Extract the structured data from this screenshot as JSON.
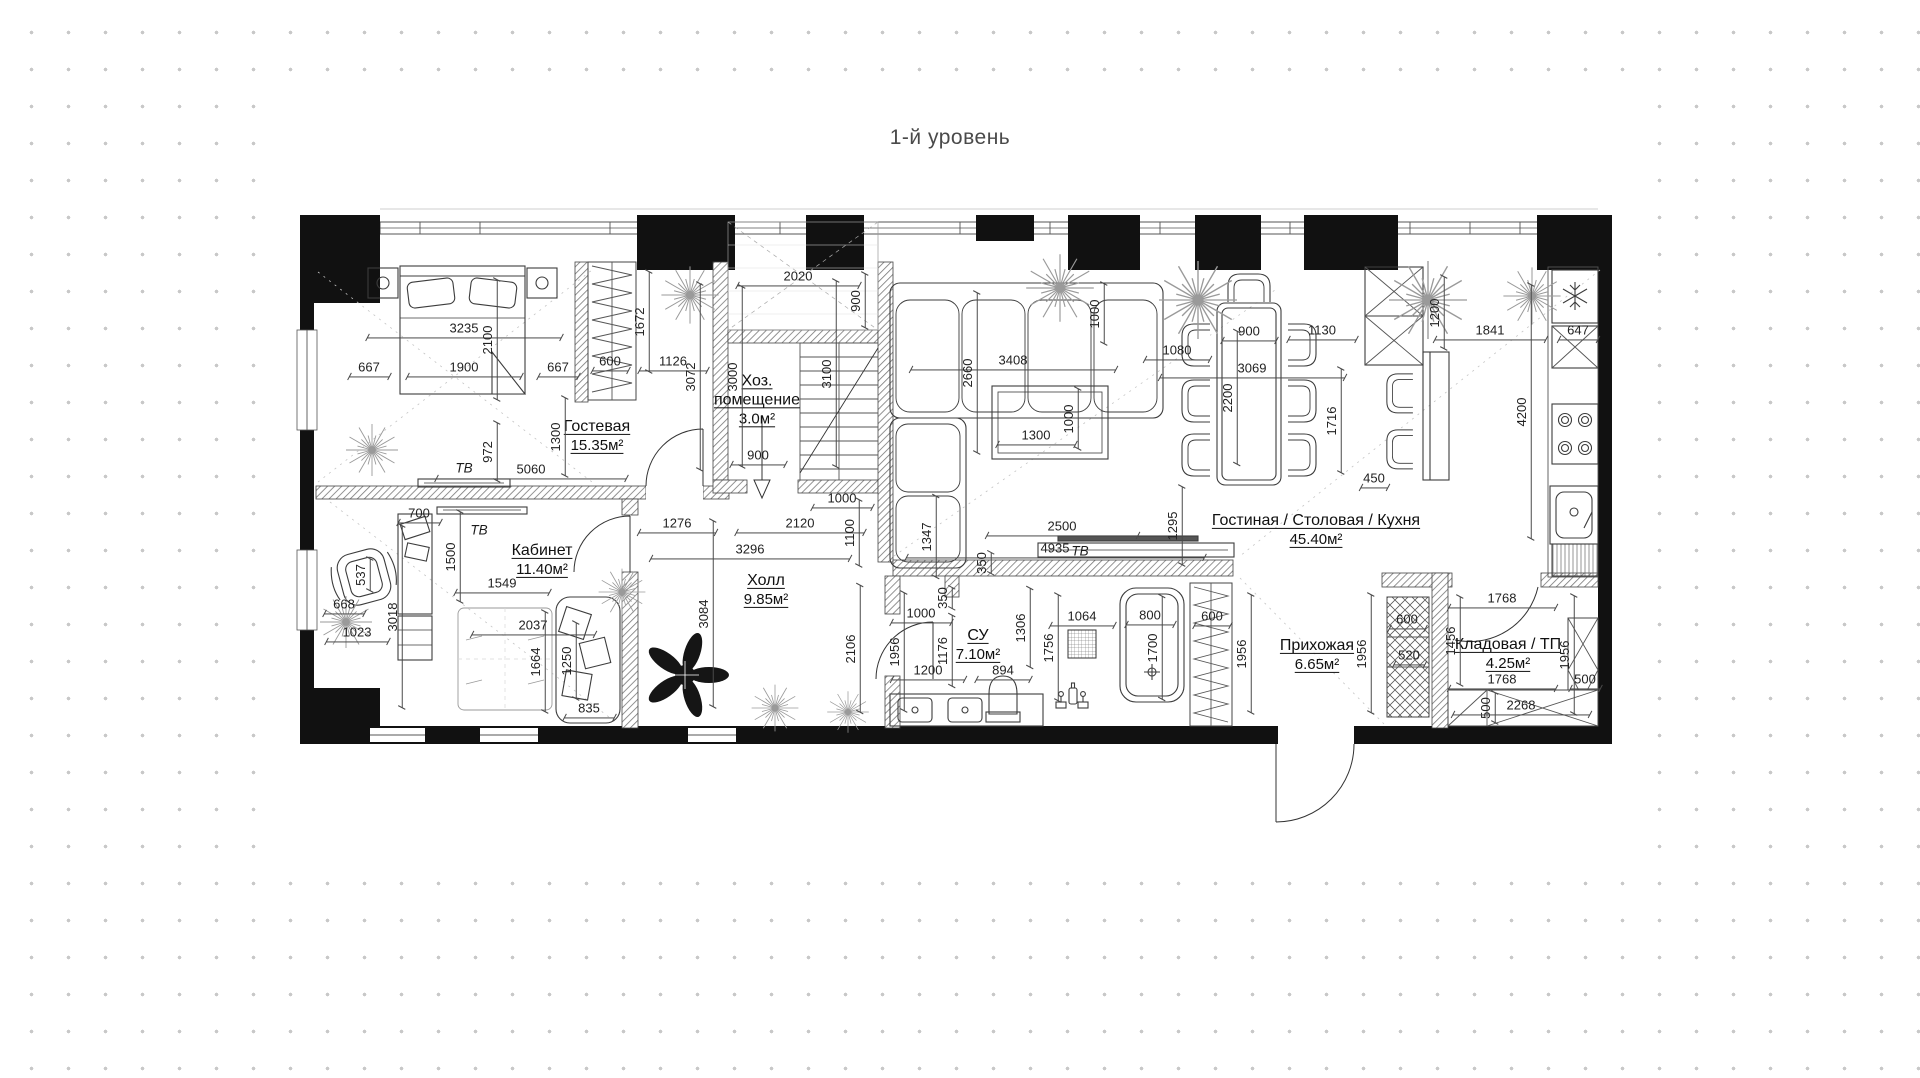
{
  "title": "1-й уровень",
  "colors": {
    "background": "#ffffff",
    "dots": "#c8c8c8",
    "walls": "#111111",
    "lines": "#3a3a3a",
    "dim_text": "#222222",
    "title_text": "#4a4a4a"
  },
  "plan": {
    "rooms": [
      {
        "name": "Гостевая",
        "area": "15.35м²",
        "cx": 597,
        "cy": 436
      },
      {
        "name": "Хоз. помещение",
        "area": "3.0м²",
        "cx": 757,
        "cy": 400,
        "w": 96
      },
      {
        "name": "Кабинет",
        "area": "11.40м²",
        "cx": 542,
        "cy": 560
      },
      {
        "name": "Холл",
        "area": "9.85м²",
        "cx": 766,
        "cy": 590
      },
      {
        "name": "СУ",
        "area": "7.10м²",
        "cx": 978,
        "cy": 645
      },
      {
        "name": "Гостиная / Столовая / Кухня",
        "area": "45.40м²",
        "cx": 1316,
        "cy": 530
      },
      {
        "name": "Прихожая",
        "area": "6.65м²",
        "cx": 1317,
        "cy": 655
      },
      {
        "name": "Кладовая / ТП",
        "area": "4.25м²",
        "cx": 1508,
        "cy": 654
      }
    ],
    "annotations": [
      {
        "t": "ТВ",
        "x": 464,
        "y": 468
      },
      {
        "t": "ТВ",
        "x": 479,
        "y": 530
      },
      {
        "t": "ТВ",
        "x": 1080,
        "y": 551
      }
    ],
    "dimensions": [
      {
        "t": "3235",
        "x": 464,
        "y": 331,
        "l": 194
      },
      {
        "t": "2100",
        "x": 489,
        "y": 340,
        "r": "v",
        "l": 120
      },
      {
        "t": "667",
        "x": 369,
        "y": 370,
        "l": 40
      },
      {
        "t": "1900",
        "x": 464,
        "y": 370,
        "l": 114
      },
      {
        "t": "667",
        "x": 558,
        "y": 370,
        "l": 40
      },
      {
        "t": "972",
        "x": 489,
        "y": 452,
        "r": "v",
        "l": 58
      },
      {
        "t": "5060",
        "x": 531,
        "y": 472,
        "l": 190
      },
      {
        "t": "1300",
        "x": 557,
        "y": 437,
        "r": "v",
        "l": 78
      },
      {
        "t": "600",
        "x": 610,
        "y": 364,
        "l": 36
      },
      {
        "t": "1126",
        "x": 673,
        "y": 364,
        "l": 68
      },
      {
        "t": "1672",
        "x": 641,
        "y": 322,
        "r": "v",
        "l": 100
      },
      {
        "t": "3072",
        "x": 692,
        "y": 377,
        "r": "v",
        "l": 186
      },
      {
        "t": "3000",
        "x": 734,
        "y": 377,
        "r": "v",
        "l": 180
      },
      {
        "t": "2020",
        "x": 798,
        "y": 279,
        "l": 122
      },
      {
        "t": "900",
        "x": 857,
        "y": 301,
        "r": "v",
        "l": 54
      },
      {
        "t": "3100",
        "x": 828,
        "y": 374,
        "r": "v",
        "l": 186
      },
      {
        "t": "900",
        "x": 758,
        "y": 458,
        "l": 54
      },
      {
        "t": "1000",
        "x": 842,
        "y": 501,
        "l": 60
      },
      {
        "t": "2120",
        "x": 800,
        "y": 526,
        "l": 128
      },
      {
        "t": "1276",
        "x": 677,
        "y": 526,
        "l": 77
      },
      {
        "t": "1100",
        "x": 851,
        "y": 533,
        "r": "v",
        "l": 66
      },
      {
        "t": "1347",
        "x": 928,
        "y": 537,
        "r": "v",
        "l": 81
      },
      {
        "t": "3296",
        "x": 750,
        "y": 552,
        "l": 199
      },
      {
        "t": "3408",
        "x": 1013,
        "y": 363,
        "l": 205
      },
      {
        "t": "2660",
        "x": 969,
        "y": 373,
        "r": "v",
        "l": 160
      },
      {
        "t": "1000",
        "x": 1096,
        "y": 314,
        "r": "v",
        "l": 60
      },
      {
        "t": "1300",
        "x": 1036,
        "y": 438,
        "l": 78
      },
      {
        "t": "1000",
        "x": 1070,
        "y": 419,
        "r": "v",
        "l": 60
      },
      {
        "t": "1080",
        "x": 1177,
        "y": 353,
        "l": 65
      },
      {
        "t": "900",
        "x": 1249,
        "y": 334,
        "l": 54
      },
      {
        "t": "1130",
        "x": 1322,
        "y": 333,
        "l": 68
      },
      {
        "t": "3069",
        "x": 1252,
        "y": 371,
        "l": 185
      },
      {
        "t": "2200",
        "x": 1229,
        "y": 398,
        "r": "v",
        "l": 133
      },
      {
        "t": "1716",
        "x": 1333,
        "y": 421,
        "r": "v",
        "l": 104
      },
      {
        "t": "450",
        "x": 1374,
        "y": 481,
        "l": 27
      },
      {
        "t": "1200",
        "x": 1436,
        "y": 313,
        "r": "v",
        "l": 72
      },
      {
        "t": "1841",
        "x": 1490,
        "y": 333,
        "l": 111
      },
      {
        "t": "647",
        "x": 1578,
        "y": 333,
        "l": 39
      },
      {
        "t": "4200",
        "x": 1523,
        "y": 412,
        "r": "v",
        "l": 254
      },
      {
        "t": "2500",
        "x": 1062,
        "y": 529,
        "l": 151
      },
      {
        "t": "4935",
        "x": 1055,
        "y": 551,
        "l": 298
      },
      {
        "t": "1295",
        "x": 1174,
        "y": 526,
        "r": "v",
        "l": 78
      },
      {
        "t": "350",
        "x": 983,
        "y": 563,
        "r": "v",
        "l": 21
      },
      {
        "t": "350",
        "x": 944,
        "y": 598,
        "r": "v",
        "l": 21
      },
      {
        "t": "1000",
        "x": 921,
        "y": 616,
        "l": 60
      },
      {
        "t": "1176",
        "x": 944,
        "y": 651,
        "r": "v",
        "l": 71
      },
      {
        "t": "1200",
        "x": 928,
        "y": 673,
        "l": 73
      },
      {
        "t": "894",
        "x": 1003,
        "y": 673,
        "l": 54
      },
      {
        "t": "1306",
        "x": 1022,
        "y": 628,
        "r": "v",
        "l": 79
      },
      {
        "t": "1756",
        "x": 1050,
        "y": 648,
        "r": "v",
        "l": 106
      },
      {
        "t": "1064",
        "x": 1082,
        "y": 619,
        "l": 64
      },
      {
        "t": "800",
        "x": 1150,
        "y": 618,
        "l": 48
      },
      {
        "t": "1700",
        "x": 1154,
        "y": 648,
        "r": "v",
        "l": 103
      },
      {
        "t": "1956",
        "x": 896,
        "y": 652,
        "r": "v",
        "l": 118
      },
      {
        "t": "2106",
        "x": 852,
        "y": 649,
        "r": "v",
        "l": 127
      },
      {
        "t": "3084",
        "x": 705,
        "y": 614,
        "r": "v",
        "l": 186
      },
      {
        "t": "600",
        "x": 1212,
        "y": 619,
        "l": 36
      },
      {
        "t": "1956",
        "x": 1243,
        "y": 654,
        "r": "v",
        "l": 118
      },
      {
        "t": "1956",
        "x": 1363,
        "y": 654,
        "r": "v",
        "l": 118
      },
      {
        "t": "520",
        "x": 1409,
        "y": 658,
        "l": 31
      },
      {
        "t": "600",
        "x": 1407,
        "y": 622,
        "l": 36
      },
      {
        "t": "1456",
        "x": 1452,
        "y": 641,
        "r": "v",
        "l": 88
      },
      {
        "t": "1768",
        "x": 1502,
        "y": 601,
        "l": 107
      },
      {
        "t": "1768",
        "x": 1502,
        "y": 682,
        "l": 107
      },
      {
        "t": "1956",
        "x": 1566,
        "y": 655,
        "r": "v",
        "l": 118
      },
      {
        "t": "500",
        "x": 1585,
        "y": 682,
        "l": 30
      },
      {
        "t": "500",
        "x": 1487,
        "y": 708,
        "r": "v",
        "l": 30
      },
      {
        "t": "2268",
        "x": 1521,
        "y": 708,
        "l": 137
      },
      {
        "t": "700",
        "x": 419,
        "y": 516,
        "l": 42
      },
      {
        "t": "1500",
        "x": 452,
        "y": 557,
        "r": "v",
        "l": 90
      },
      {
        "t": "1549",
        "x": 502,
        "y": 586,
        "l": 94
      },
      {
        "t": "537",
        "x": 362,
        "y": 575,
        "r": "v",
        "l": 32
      },
      {
        "t": "668",
        "x": 344,
        "y": 607,
        "l": 40
      },
      {
        "t": "1023",
        "x": 357,
        "y": 635,
        "l": 62
      },
      {
        "t": "3018",
        "x": 394,
        "y": 617,
        "r": "v",
        "l": 182
      },
      {
        "t": "2037",
        "x": 533,
        "y": 628,
        "l": 123
      },
      {
        "t": "1664",
        "x": 537,
        "y": 662,
        "r": "v",
        "l": 100
      },
      {
        "t": "1250",
        "x": 568,
        "y": 661,
        "r": "v",
        "l": 76
      },
      {
        "t": "835",
        "x": 589,
        "y": 711,
        "l": 50
      }
    ]
  }
}
